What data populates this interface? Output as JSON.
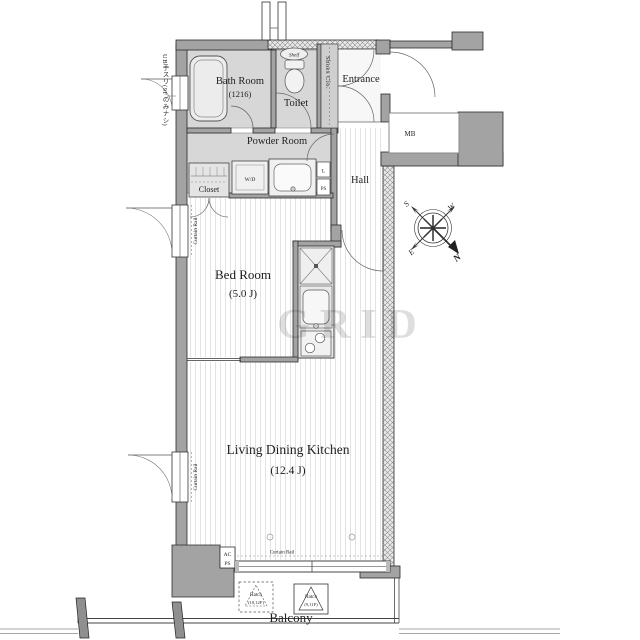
{
  "plan": {
    "rooms": {
      "bath": {
        "label": "Bath Room",
        "size": "(1216)"
      },
      "toilet": {
        "label": "Toilet"
      },
      "powder": {
        "label": "Powder Room"
      },
      "entrance": {
        "label": "Entrance"
      },
      "shoes_closet": {
        "label": "Shoes Clo."
      },
      "hall": {
        "label": "Hall"
      },
      "closet": {
        "label": "Closet"
      },
      "bedroom": {
        "label": "Bed Room",
        "size": "(5.0 J)"
      },
      "ldk": {
        "label": "Living Dining Kitchen",
        "size": "(12.4 J)"
      },
      "balcony": {
        "label": "Balcony"
      }
    },
    "fixtures": {
      "washer_dryer": "W/D",
      "linen": "L",
      "pipe_space": "PS",
      "shelf": "Shelf",
      "meter_box": "MB",
      "ac": "AC",
      "ac_ps": "PS"
    },
    "annotations": {
      "curtain_rail": "Curtain Rail",
      "hatch_left": {
        "title": "Hatch",
        "floors": "(10,12F)"
      },
      "hatch_right": {
        "title": "Hatch",
        "floors": "(9,11F)"
      },
      "side_note": "UB手スリ(9Fのみナシ)",
      "watermark": "GRID"
    },
    "compass": {
      "n": "N",
      "s": "S",
      "e": "E",
      "w": "W"
    }
  }
}
